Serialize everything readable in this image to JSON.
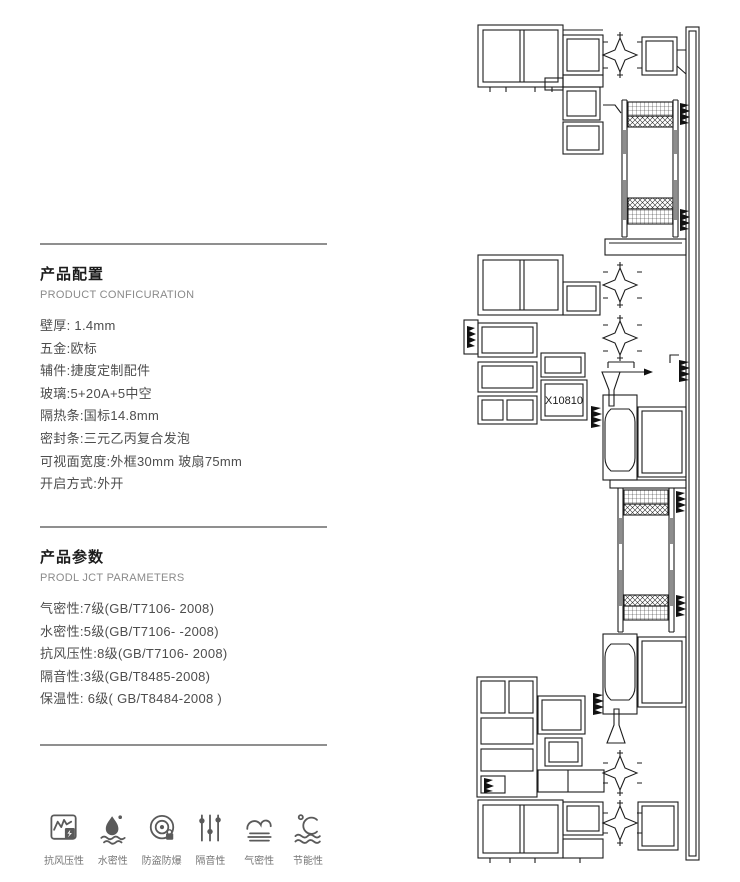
{
  "config_section": {
    "title": "产品配置",
    "subtitle": "PRODUCT CONFICURATION",
    "items": [
      "壁厚: 1.4mm",
      "五金:欧标",
      "辅件:捷度定制配件",
      "玻璃:5+20A+5中空",
      "隔热条:国标14.8mm",
      "密封条:三元乙丙复合发泡",
      "可视面宽度:外框30mm 玻扇75mm",
      "开启方式:外开"
    ]
  },
  "params_section": {
    "title": "产品参数",
    "subtitle": "PRODL JCT PARAMETERS",
    "items": [
      "气密性:7级(GB/T7106- 2008)",
      "水密性:5级(GB/T7106- -2008)",
      "抗风压性:8级(GB/T7106- 2008)",
      "隔音性:3级(GB/T8485-2008)",
      "保温性: 6级( GB/T8484-2008 )"
    ]
  },
  "features": [
    {
      "icon": "wind-pressure-icon",
      "label": "抗风压性"
    },
    {
      "icon": "water-tightness-icon",
      "label": "水密性"
    },
    {
      "icon": "anti-theft-icon",
      "label": "防盗防爆"
    },
    {
      "icon": "sound-insulation-icon",
      "label": "隔音性"
    },
    {
      "icon": "air-tightness-icon",
      "label": "气密性"
    },
    {
      "icon": "energy-saving-icon",
      "label": "节能性"
    }
  ],
  "drawing": {
    "type": "window-profile-cross-section",
    "label": "X10810"
  },
  "colors": {
    "line": "#1c1c1c",
    "divider": "#8f8f8f",
    "text_primary": "#1c1c1c",
    "text_secondary": "#4d4d4d",
    "text_muted": "#8a8a8a",
    "glass_shade": "#8d8d8d"
  }
}
